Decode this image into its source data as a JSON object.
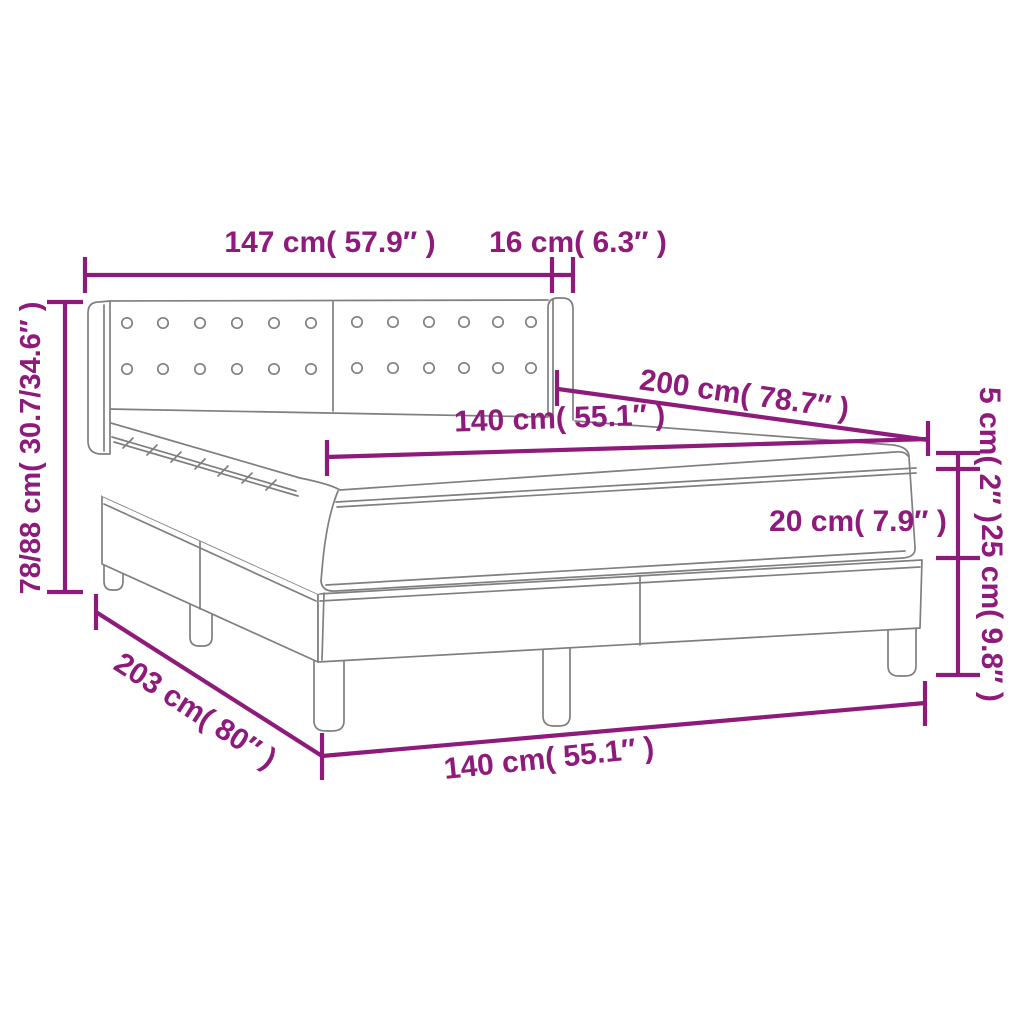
{
  "diagram": {
    "kind": "product-dimension-drawing",
    "colors": {
      "dimension": "#8E1B7B",
      "line_art": "#7F7F7F",
      "background": "#FFFFFF"
    },
    "labels": {
      "headboard_width": "147 cm( 57.9″ )",
      "wing_width": "16 cm( 6.3″ )",
      "total_height_range": "78/88 cm( 30.7/34.6″ )",
      "bed_length": "200 cm( 78.7″ )",
      "mattress_width": "140 cm( 55.1″ )",
      "topper_height": "5 cm( 2″ )",
      "mattress_height": "20 cm( 7.9″ )",
      "base_height": "25 cm( 9.8″ )",
      "base_length": "203 cm( 80″ )",
      "base_width": "140 cm( 55.1″ )"
    }
  }
}
